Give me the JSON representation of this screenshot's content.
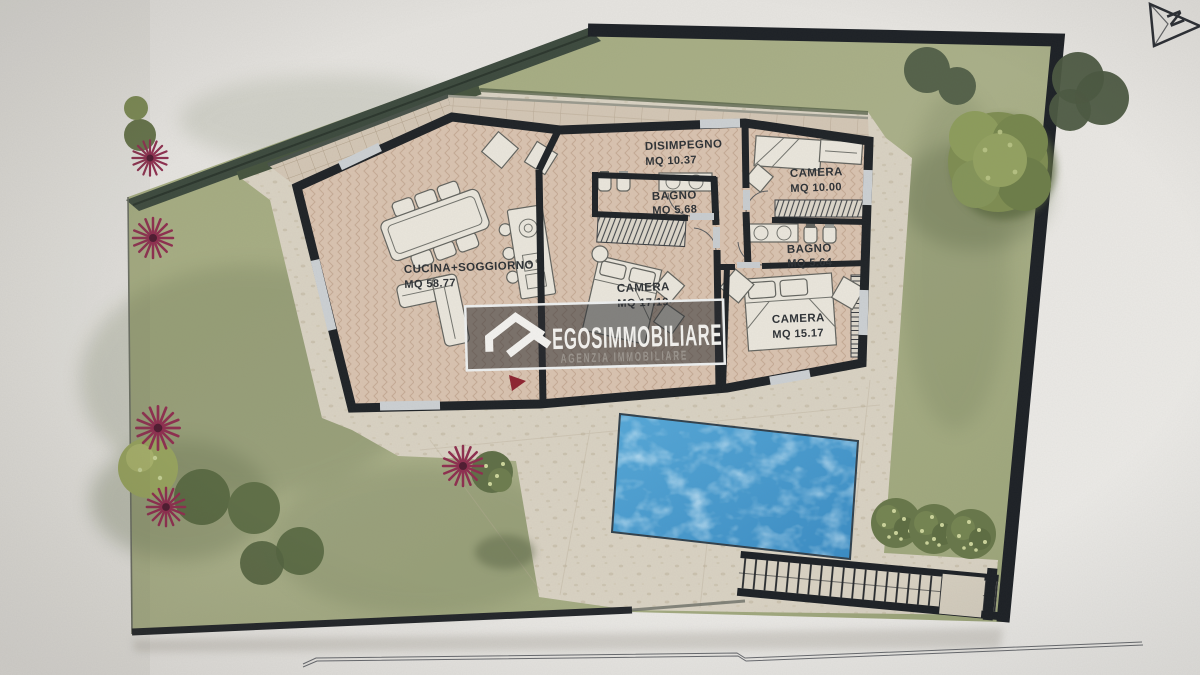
{
  "plan": {
    "compass_label": "N",
    "rooms": {
      "cucina": {
        "name": "CUCINA+SOGGIORNO",
        "area": "MQ 58.77"
      },
      "disimpegno": {
        "name": "DISIMPEGNO",
        "area": "MQ 10.37"
      },
      "bagno1": {
        "name": "BAGNO",
        "area": "MQ 5.68"
      },
      "camera1": {
        "name": "CAMERA",
        "area": "MQ 10.00"
      },
      "bagno2": {
        "name": "BAGNO",
        "area": "MQ 5.64"
      },
      "camera2": {
        "name": "CAMERA",
        "area": "MQ 17.19"
      },
      "camera3": {
        "name": "CAMERA",
        "area": "MQ 15.17"
      }
    },
    "watermark": {
      "brand": "EGOSIMMOBILIARE",
      "tagline": "AGENZIA IMMOBILIARE"
    },
    "palette": {
      "paper": "#e9e7e3",
      "lawn": "#a6ad83",
      "hedge": "#3d4a3e",
      "walls": "#1f2327",
      "floor": "#d9c3b0",
      "deck": "#d9d2c3",
      "pool": "#4095cf",
      "entrance_red": "#8e2430"
    }
  }
}
